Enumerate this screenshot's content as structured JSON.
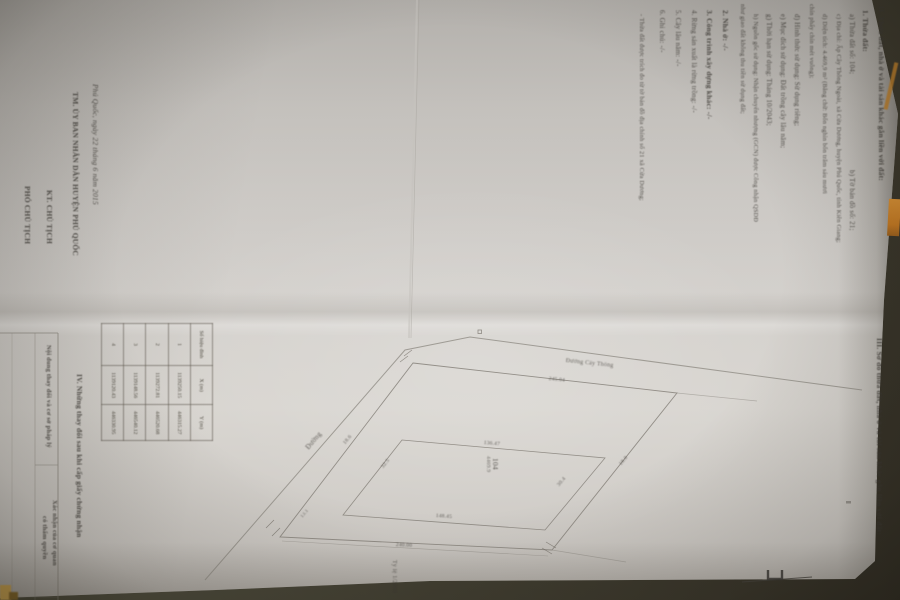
{
  "colors": {
    "paper": "#d3d0cc",
    "background": "#464436",
    "ink": "#3b3833",
    "diagram_line": "#86817a",
    "cover_orange": "#c8822e"
  },
  "section2": {
    "lines": [
      {
        "t": "II. Thửa đất, nhà ở và tài sản khác gắn liền với đất:",
        "x": 886,
        "y": 6,
        "s": 7.5,
        "w": 700
      },
      {
        "t": "1. Thửa đất:",
        "x": 870,
        "y": 10,
        "s": 7.5,
        "w": 700
      },
      {
        "t": "a) Thửa đất số: 104;",
        "x": 856,
        "y": 14,
        "s": 7
      },
      {
        "t": "b) Tờ bản đồ số: 21;",
        "x": 856,
        "y": 170,
        "s": 7
      },
      {
        "t": "c) Địa chỉ: Ấp Cây Thông Ngoài, xã Cửa Dương, huyện Phú Quốc, tỉnh Kiên Giang;",
        "x": 842,
        "y": 14,
        "s": 6.3
      },
      {
        "t": "d) Diện tích: 4.469,9 m² (Bằng chữ: Bốn nghìn bốn trăm sáu mươi",
        "x": 828,
        "y": 14,
        "s": 6.3
      },
      {
        "t": "chín phẩy chín mét vuông);",
        "x": 815,
        "y": 4,
        "s": 6.3
      },
      {
        "t": "đ) Hình thức sử dụng: Sử dụng riêng;",
        "x": 801,
        "y": 14,
        "s": 7
      },
      {
        "t": "e) Mục đích sử dụng: Đất trồng cây lâu năm;",
        "x": 787,
        "y": 14,
        "s": 7
      },
      {
        "t": "g) Thời hạn sử dụng: Tháng 10/2043;",
        "x": 773,
        "y": 14,
        "s": 7
      },
      {
        "t": "h) Nguồn gốc sử dụng: Nhận chuyển nhượng (GCN) được Công nhận QSDĐ",
        "x": 759,
        "y": 14,
        "s": 6.3
      },
      {
        "t": "như giao đất không thu tiền sử dụng đất;",
        "x": 746,
        "y": 4,
        "s": 6.3
      },
      {
        "t": "2. Nhà ở: -/-",
        "x": 730,
        "y": 10,
        "s": 7.5,
        "w": 600
      },
      {
        "t": "3. Công trình xây dựng khác: -/-",
        "x": 714,
        "y": 10,
        "s": 7.5,
        "w": 600
      },
      {
        "t": "4. Rừng sản xuất là rừng trồng: -/-",
        "x": 698,
        "y": 10,
        "s": 7
      },
      {
        "t": "5. Cây lâu năm: -/-",
        "x": 682,
        "y": 10,
        "s": 7
      },
      {
        "t": "6. Ghi chú: -/-",
        "x": 666,
        "y": 10,
        "s": 7
      },
      {
        "t": "- Thửa đất được trích đo từ tờ bản đồ địa chính số 21 xã Cửa Dương;",
        "x": 645,
        "y": 14,
        "s": 6.3
      }
    ]
  },
  "signature": {
    "lines": [
      {
        "t": "Phú Quốc, ngày 22 tháng 6 năm 2015",
        "x": 100,
        "y": 84,
        "s": 7.5,
        "i": 1
      },
      {
        "t": "TM. ỦY BAN NHÂN DÂN HUYỆN PHÚ QUỐC",
        "x": 80,
        "y": 92,
        "s": 7.5,
        "w": 700
      },
      {
        "t": "KT. CHỦ TỊCH",
        "x": 54,
        "y": 190,
        "s": 7.5,
        "w": 700
      },
      {
        "t": "PHÓ CHỦ TỊCH",
        "x": 32,
        "y": 186,
        "s": 7.5,
        "w": 700
      }
    ]
  },
  "section3": {
    "lines": [
      {
        "t": "III. Sơ đồ thửa đất, nhà ở và tài sản khác gắn liền với đất:",
        "x": 884,
        "y": 338,
        "s": 7.5,
        "w": 700
      },
      {
        "t": "Tỷ lệ 1/2000",
        "x": 397,
        "y": 560,
        "s": 6,
        "o": 0.7
      }
    ]
  },
  "section4": {
    "lines": [
      {
        "t": "IV. Những thay đổi sau khi cấp giấy chứng nhận",
        "x": 84,
        "y": 374,
        "s": 7.5,
        "w": 700
      },
      {
        "t": "Nội dung thay đổi và cơ sở pháp lý",
        "x": 52,
        "y": 345,
        "s": 6.5,
        "w": 600
      },
      {
        "t": "Xác nhận của cơ quan",
        "x": 58,
        "y": 500,
        "s": 6.5,
        "w": 600
      },
      {
        "t": "có thẩm quyền",
        "x": 48,
        "y": 516,
        "s": 6.5,
        "w": 600
      }
    ]
  },
  "diagram": {
    "labels": [
      {
        "t": "Đường",
        "x": 304,
        "y": 446,
        "s": 7,
        "r": -50,
        "o": 0.75
      },
      {
        "t": "Đường Cây Thông",
        "x": 566,
        "y": 358,
        "s": 6,
        "r": 6,
        "o": 0.7
      },
      {
        "t": "245.04",
        "x": 549,
        "y": 376,
        "s": 5.5,
        "r": 6,
        "o": 0.75
      },
      {
        "t": "240.00",
        "x": 396,
        "y": 542,
        "s": 5.5,
        "r": 3,
        "o": 0.75
      },
      {
        "t": "136.47",
        "x": 484,
        "y": 440,
        "s": 5.5,
        "r": 5,
        "o": 0.75
      },
      {
        "t": "148.45",
        "x": 436,
        "y": 513,
        "s": 5.5,
        "r": 4,
        "o": 0.75
      },
      {
        "t": "32.5",
        "x": 380,
        "y": 466,
        "s": 5.5,
        "r": -52,
        "o": 0.75
      },
      {
        "t": "30.4",
        "x": 556,
        "y": 484,
        "s": 5.5,
        "r": -50,
        "o": 0.75
      },
      {
        "t": "18.6",
        "x": 342,
        "y": 442,
        "s": 5.5,
        "r": -50,
        "o": 0.75
      },
      {
        "t": "18.0",
        "x": 618,
        "y": 463,
        "s": 5.5,
        "r": -50,
        "o": 0.75
      },
      {
        "t": "13.1",
        "x": 300,
        "y": 516,
        "s": 5,
        "r": -50,
        "o": 0.7
      },
      {
        "t": "104",
        "x": 500,
        "y": 458,
        "s": 7.5,
        "r": 90,
        "o": 0.8
      },
      {
        "t": "4469.9",
        "x": 491,
        "y": 456,
        "s": 5.5,
        "r": 90,
        "o": 0.7
      }
    ]
  },
  "coord_table": {
    "headers": [
      "Số hiệu đỉnh",
      "X (m)",
      "Y (m)"
    ],
    "rows": [
      [
        "1",
        "1139250.15",
        "446315.27"
      ],
      [
        "2",
        "1139272.81",
        "446520.68"
      ],
      [
        "3",
        "1139148.56",
        "446540.12"
      ],
      [
        "4",
        "1139120.43",
        "446330.95"
      ]
    ]
  }
}
